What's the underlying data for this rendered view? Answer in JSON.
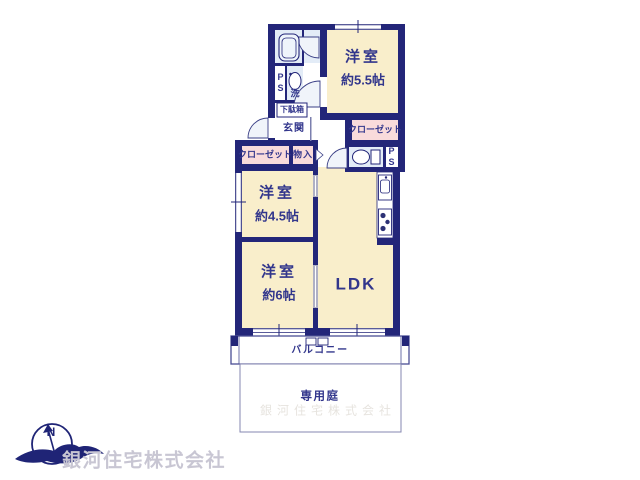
{
  "rooms": {
    "bedroom_top": {
      "name": "洋室",
      "size": "約5.5帖"
    },
    "bedroom_mid": {
      "name": "洋室",
      "size": "約4.5帖"
    },
    "bedroom_bottom": {
      "name": "洋室",
      "size": "約6帖"
    },
    "ldk": {
      "name": "LDK"
    },
    "balcony": {
      "name": "バルコニー"
    },
    "garden": {
      "name": "専用庭"
    }
  },
  "fixtures": {
    "closet_right": "クローゼット",
    "closet_left": "クローゼット",
    "storage": "物入",
    "entrance": "玄関",
    "shoe_cabinet": "下駄箱",
    "washbasin": "洗",
    "pipe_space_top": "PS",
    "pipe_space_right": "PS"
  },
  "branding": {
    "company": "銀河住宅株式会社",
    "compass_letter": "N",
    "watermark": "銀河住宅株式会社"
  },
  "colors": {
    "wall": "#232679",
    "label": "#32368c",
    "room_fill": "#f9eecb",
    "closet_fill": "#f9dbdb",
    "wet_area_fill": "#e3ecf7",
    "sliding_door": "#b0b0c4",
    "balcony_border": "#4a4e94",
    "garden_border": "#8587b0",
    "company_text": "#c8c6d3"
  }
}
